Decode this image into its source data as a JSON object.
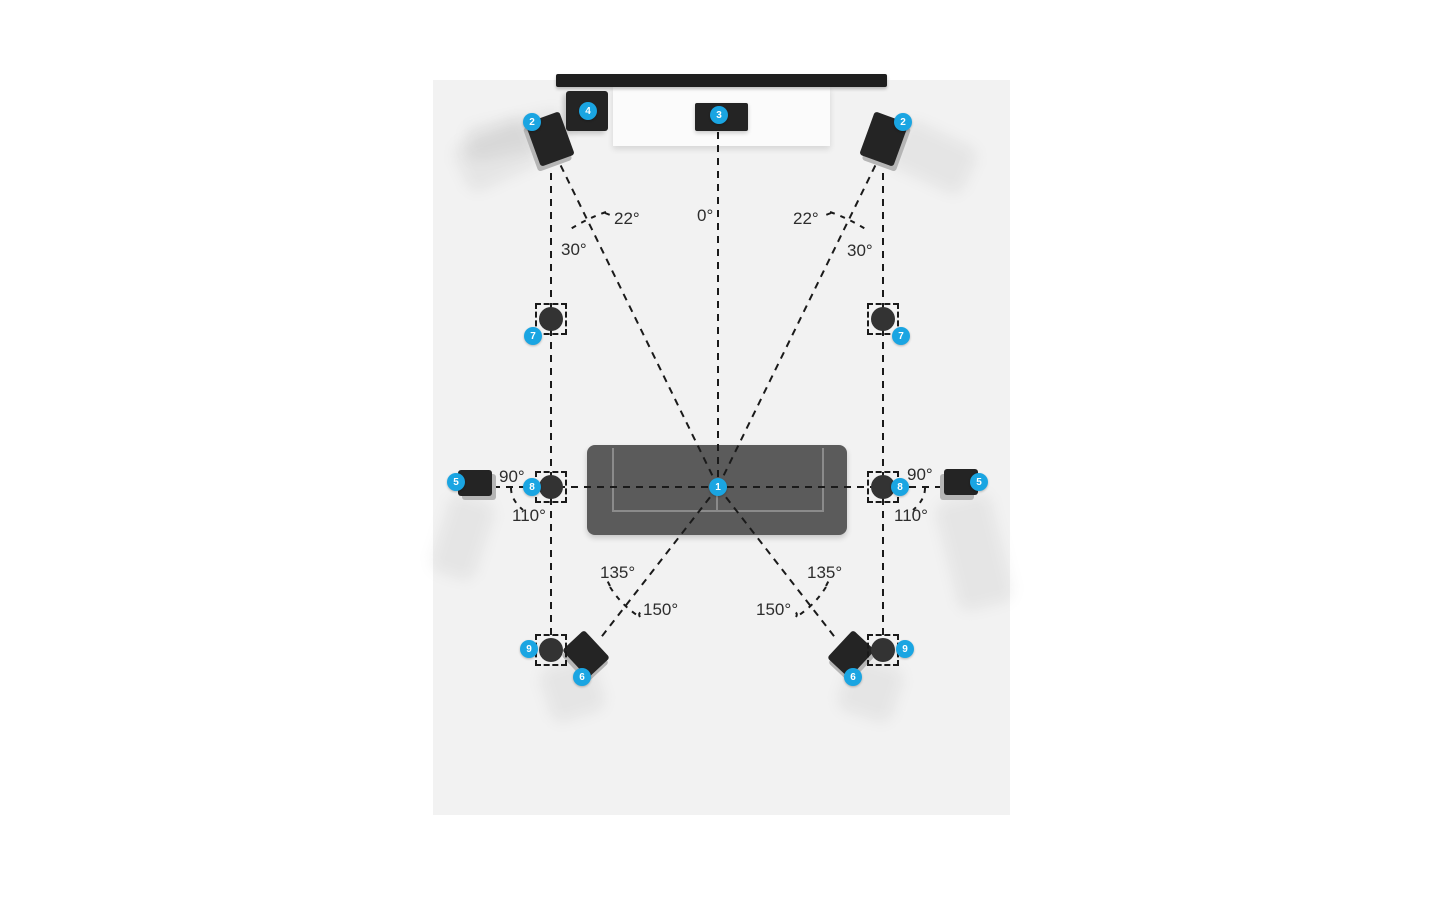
{
  "badges": {
    "listening_position": "1",
    "front_left": "2",
    "front_right": "2",
    "center_speaker": "3",
    "subwoofer": "4",
    "side_left": "5",
    "side_right": "5",
    "rear_left": "6",
    "rear_right": "6",
    "height_front_left": "7",
    "height_front_right": "7",
    "height_middle_left": "8",
    "height_middle_right": "8",
    "height_rear_left": "9",
    "height_rear_right": "9"
  },
  "angle_labels": {
    "center": "0°",
    "front_min_left": "22°",
    "front_max_left": "30°",
    "front_min_right": "22°",
    "front_max_right": "30°",
    "side_min_left": "90°",
    "side_max_left": "110°",
    "side_min_right": "90°",
    "side_max_right": "110°",
    "rear_min_left": "135°",
    "rear_max_left": "150°",
    "rear_min_right": "135°",
    "rear_max_right": "150°"
  },
  "colors": {
    "badge_blue": "#1aa5e2",
    "room_floor": "#f2f2f2",
    "speaker_black": "#242424",
    "speaker_base_gray": "#b5b5b5",
    "sofa_gray": "#5b5b5b",
    "sofa_line_gray": "#8b8b8b",
    "guide_line": "#1a1a1a",
    "label_text": "#2d2d2d"
  }
}
